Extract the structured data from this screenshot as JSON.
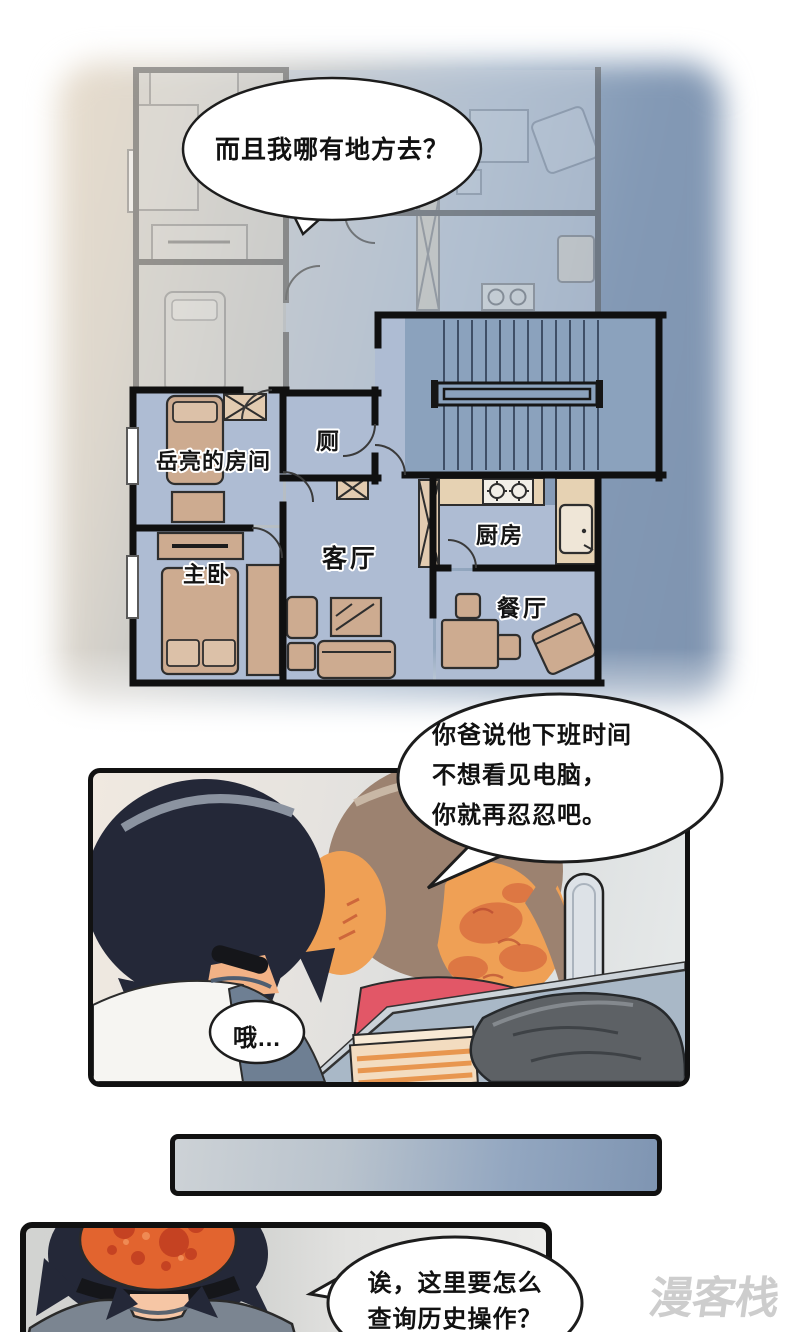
{
  "bubbles": {
    "top": {
      "text": "而且我哪有地方去？"
    },
    "mom": {
      "lines": [
        "你爸说他下班时间",
        "不想看见电脑，",
        "你就再忍忍吧。"
      ]
    },
    "oh": {
      "text": "哦…"
    },
    "ask": {
      "lines": [
        "诶，这里要怎么",
        "查询历史操作？"
      ]
    }
  },
  "floorplan": {
    "labels": {
      "yueliang_room": "岳亮的房间",
      "toilet": "厕",
      "living_room": "客厅",
      "kitchen": "厨房",
      "master_bedroom": "主卧",
      "dining_room": "餐厅"
    }
  },
  "watermark": {
    "text": "漫客栈"
  },
  "colors": {
    "wall": "#101010",
    "wall_faded": "#5b5b5b",
    "floor_blue": "#aebcd3",
    "stair_blue": "#8ba2bd",
    "floor_faded": "#c3cdda",
    "room_faded": "#d6d5d1",
    "furniture_tan": "#cdab90",
    "furniture_tan_light": "#dcc1a8",
    "counter_beige": "#e6d2b3",
    "xbox_tan": "#e2cbb0",
    "bg_beige": "#e8ddcd",
    "bg_blue": "#7e93af",
    "hair_navy": "#242838",
    "hair_brown": "#9c8270",
    "hair_streak": "#8b93a0",
    "skin_orange": "#efa055",
    "skin_pink": "#f6c6a5",
    "blush_red": "#cc4f33",
    "sweater_pink": "#e25767",
    "sleeve_blue": "#6e7f93",
    "shirt_white": "#f6f5f2",
    "shirt_gray": "#7b8591",
    "desk_blue": "#a9b8c7",
    "desk_edge": "#ccd3d9",
    "cloth_gray": "#5d6165",
    "paper_tan": "#f3dcc0",
    "paper_stripe": "#e8964f",
    "scalp_orange": "#e2642f",
    "scalp_spot": "#c03d20",
    "bar_light": "#cdd2d6",
    "bar_blue": "#7f95b2",
    "bubble_stroke": "#1d1d1d",
    "watermark_gray": "#cdcdcd"
  }
}
